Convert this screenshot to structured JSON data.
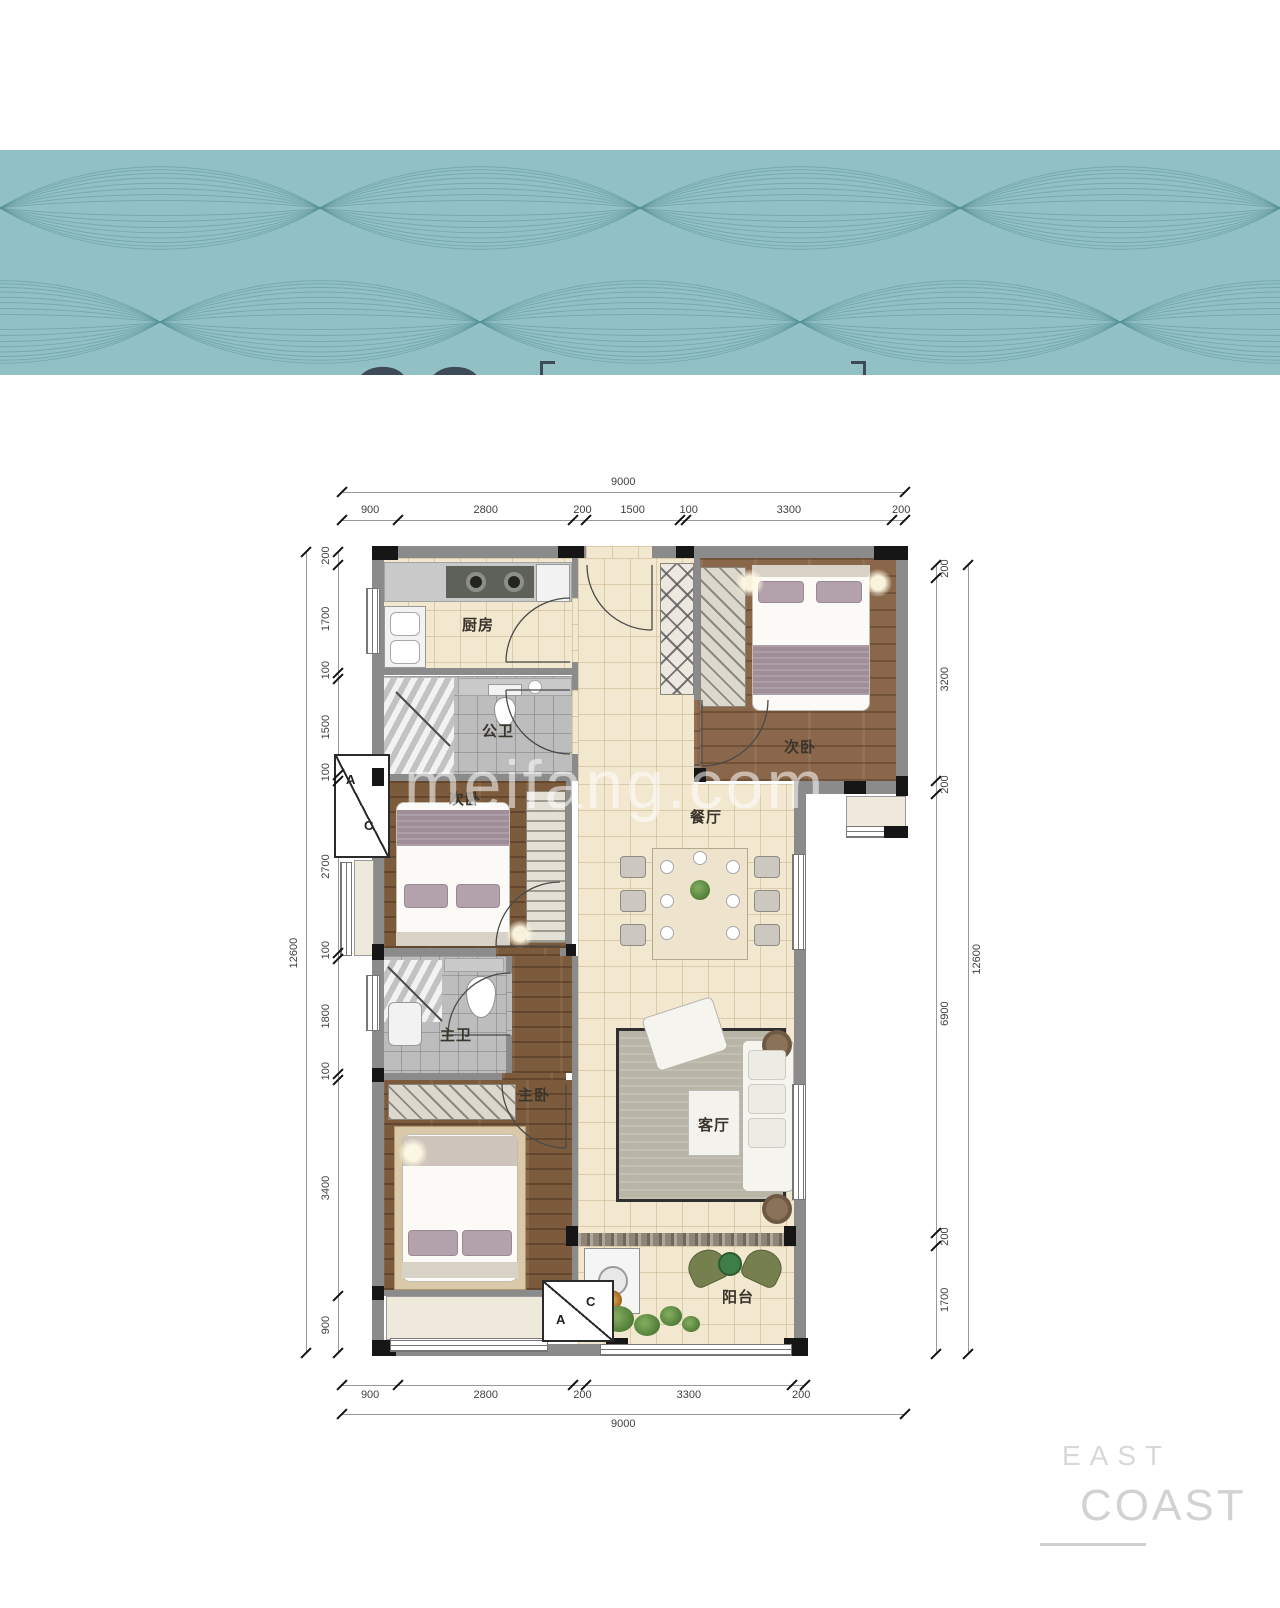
{
  "banner": {
    "unit_number": "06",
    "unit_suffix": "户型",
    "layout_title": "三室两厅两卫",
    "areas": [
      {
        "label_top": "建 筑",
        "label_bottom": "面积约",
        "value": "101",
        "unit": "m",
        "sup": "2"
      },
      {
        "label_top": "套 内",
        "label_bottom": "面积约",
        "value": "80",
        "unit": "m",
        "sup": "2"
      }
    ]
  },
  "plan": {
    "rooms": {
      "kitchen": "厨房",
      "public_bath": "公卫",
      "bedroom_top": "次卧",
      "bedroom_left": "次卧",
      "dining": "餐厅",
      "master_bath": "主卫",
      "master_bedroom": "主卧",
      "living": "客厅",
      "balcony": "阳台"
    },
    "ac_left": {
      "a": "A",
      "c": "C"
    },
    "ac_bottom": {
      "a": "A",
      "c": "C"
    },
    "dims": {
      "top_total": "9000",
      "top_segments": [
        "900",
        "2800",
        "200",
        "1500",
        "100",
        "3300",
        "200"
      ],
      "bottom_segments": [
        "900",
        "2800",
        "200",
        "3300",
        "200"
      ],
      "bottom_total": "9000",
      "left_total": "12600",
      "left_segments": [
        "200",
        "1700",
        "100",
        "1500",
        "100",
        "2700",
        "100",
        "1800",
        "100",
        "3400",
        "900"
      ],
      "right_segments": [
        "200",
        "3200",
        "200",
        "6900",
        "200",
        "1700"
      ],
      "right_total": "12600"
    }
  },
  "watermark": "meifang.com",
  "brand": {
    "line1": "EAST",
    "line2": "COAST"
  },
  "colors": {
    "banner_bg": "#92c1c5",
    "wave_line": "#4f8b92",
    "ink": "#3d4b57",
    "wall": "#8b8b8b",
    "floor_beige": "#f2e7cf",
    "wood": "#7c5a3c",
    "brand_gray": "#d5d5d5"
  }
}
